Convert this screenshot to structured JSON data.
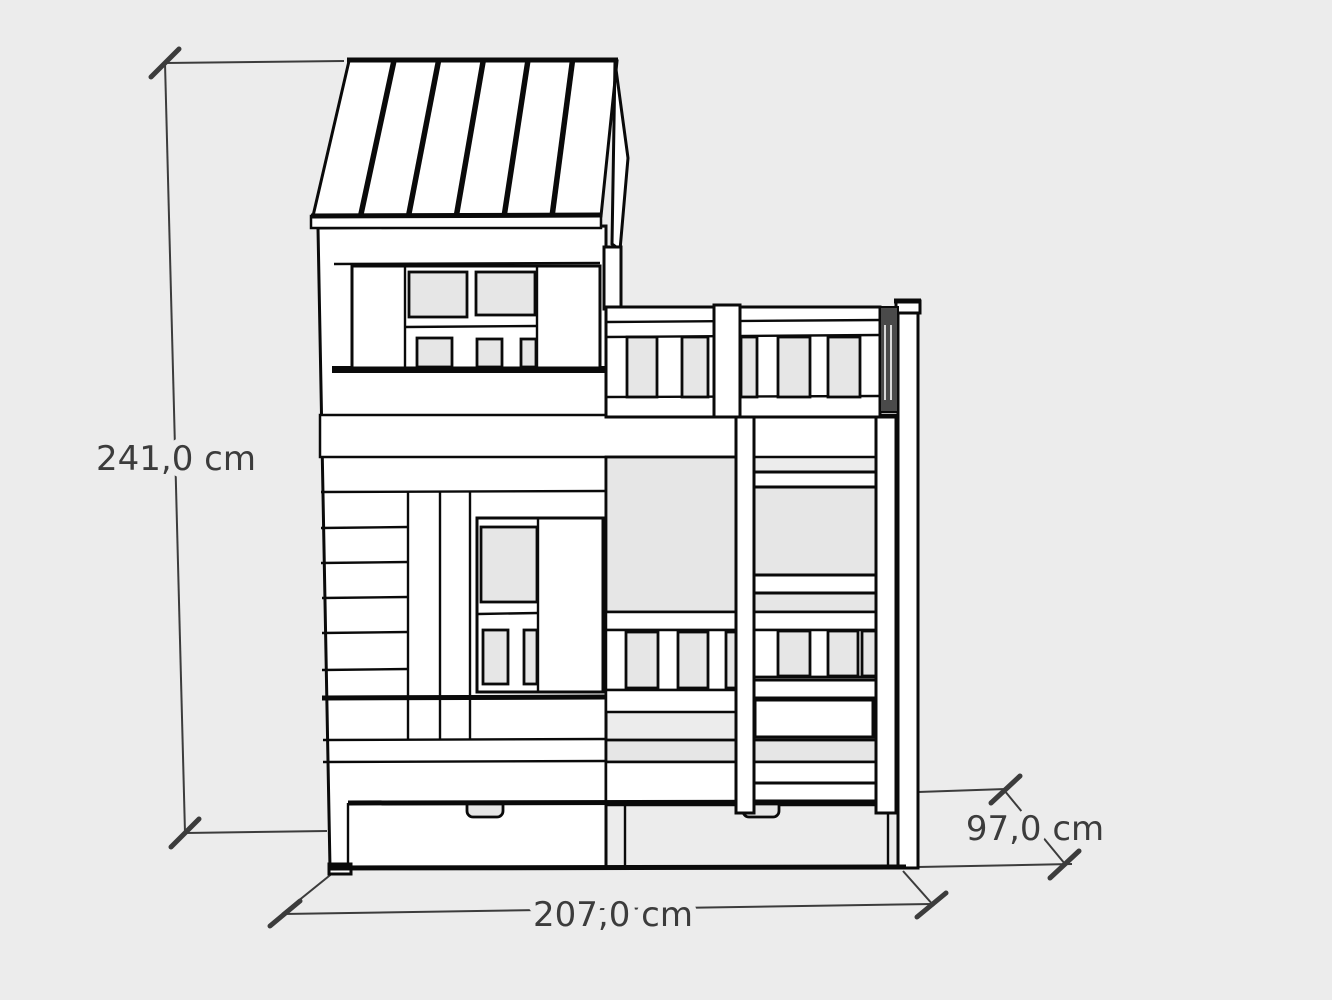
{
  "dimensions": {
    "height": {
      "label": "241,0 cm"
    },
    "width": {
      "label": "207,0 cm"
    },
    "depth": {
      "label": "97,0 cm"
    }
  },
  "colors": {
    "background": "#ececec",
    "outline": "#0a0a0a",
    "surface": "#ffffff",
    "opening": "#e6e6e6",
    "shaded_side": "#4a4a4a",
    "dimension": "#3c3c3c"
  }
}
